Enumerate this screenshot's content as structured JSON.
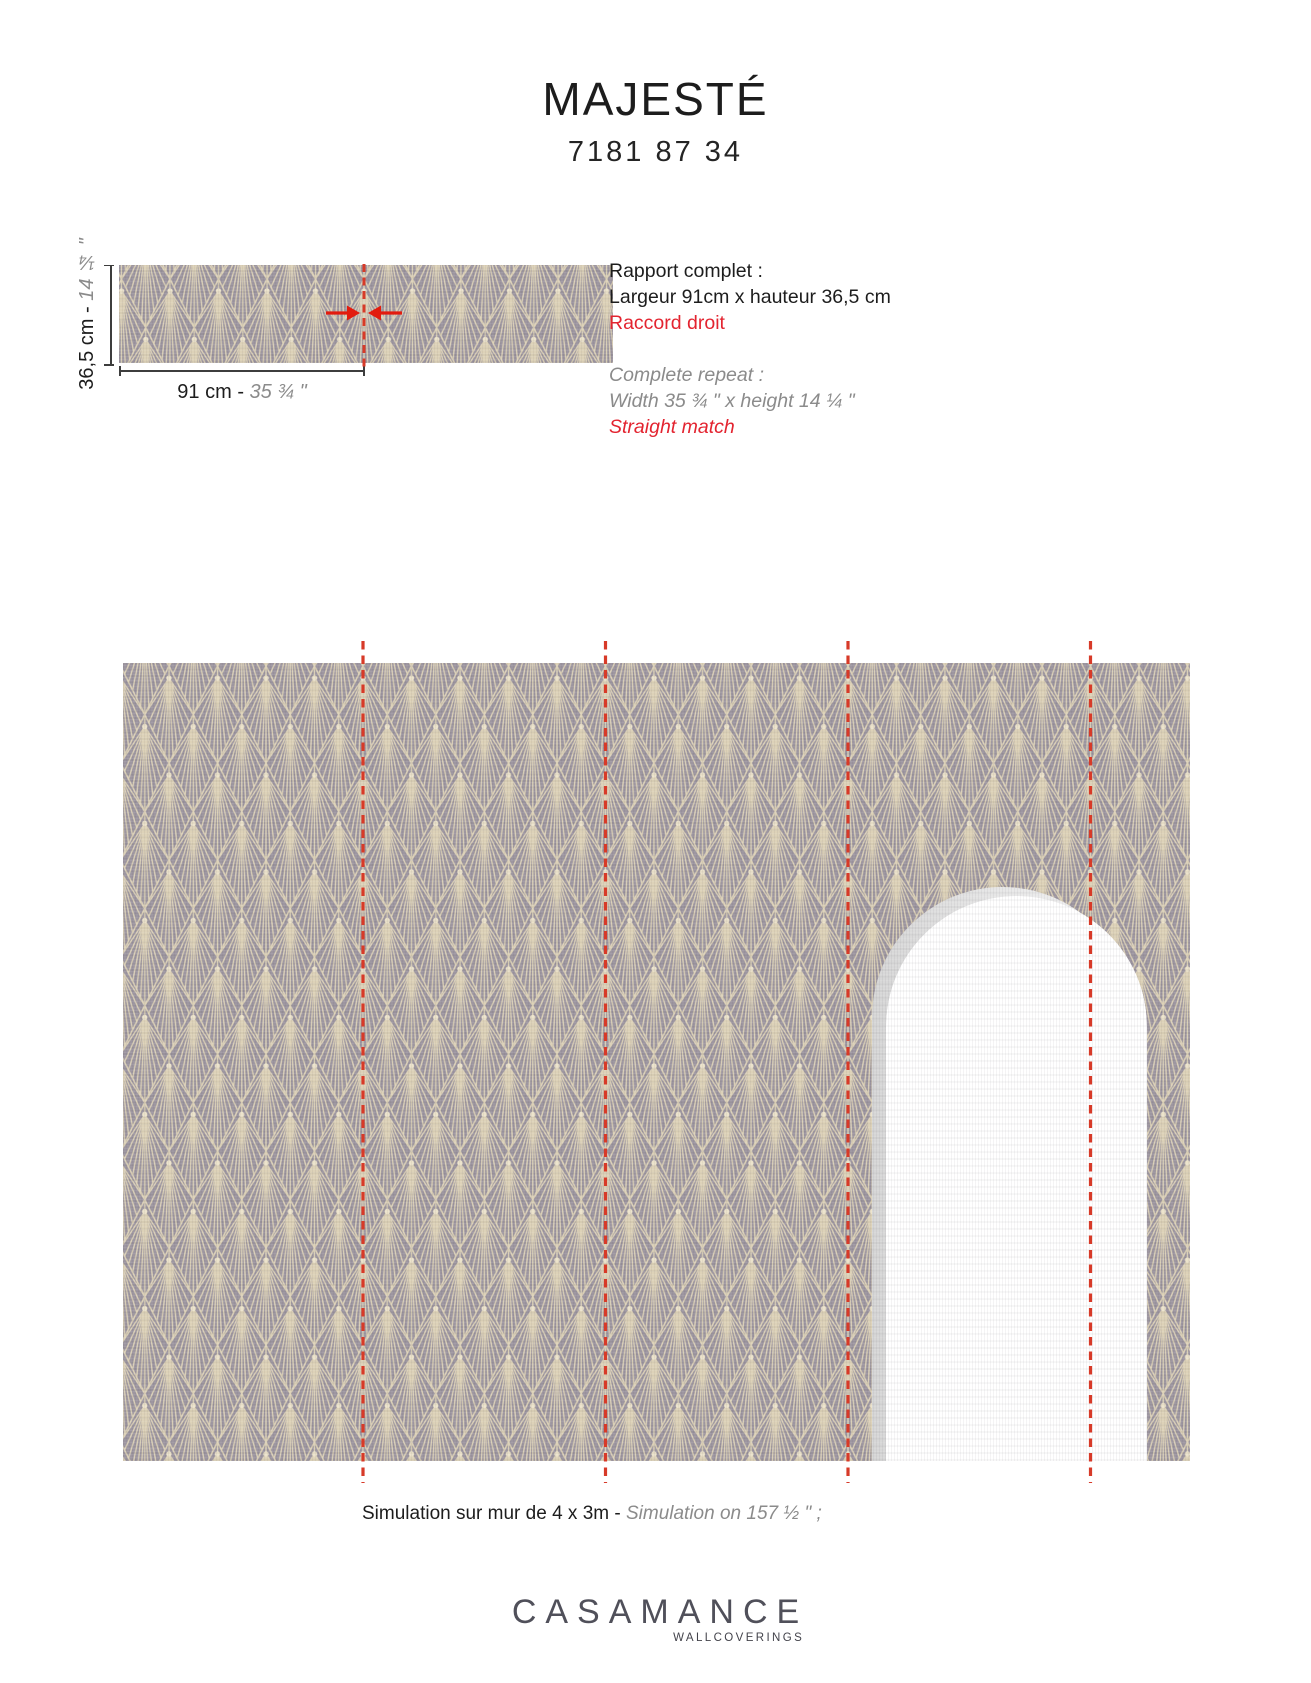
{
  "title": "MAJESTÉ",
  "reference": "7181 87 34",
  "spec": {
    "fr": {
      "heading": "Rapport complet :",
      "dimensions": "Largeur 91cm x hauteur 36,5 cm",
      "match": "Raccord droit"
    },
    "en": {
      "heading": "Complete repeat :",
      "dimensions": "Width 35 ¾ \" x height 14 ¼ \"",
      "match": "Straight match"
    }
  },
  "dimensions": {
    "height_metric": "36,5 cm - ",
    "height_imperial": "14 ¼ \"",
    "width_metric": "91 cm - ",
    "width_imperial": "35 ¾ \""
  },
  "caption": {
    "fr": "Simulation sur mur de 4 x 3m - ",
    "en": "Simulation on 157 ½ \" ;"
  },
  "brand": {
    "name": "CASAMANCE",
    "tagline": "WALLCOVERINGS"
  },
  "colors": {
    "wallpaper_background": "#9d96a0",
    "wallpaper_line": "#ddd2b8",
    "wallpaper_dot": "#ece3cb",
    "seam_dash_red": "#d73a28",
    "arrow_red": "#e21b0e",
    "match_text_red": "#e32430",
    "text_black": "#1d1d1d",
    "text_gray": "#8b8b8b",
    "brand_gray": "#50505a"
  }
}
